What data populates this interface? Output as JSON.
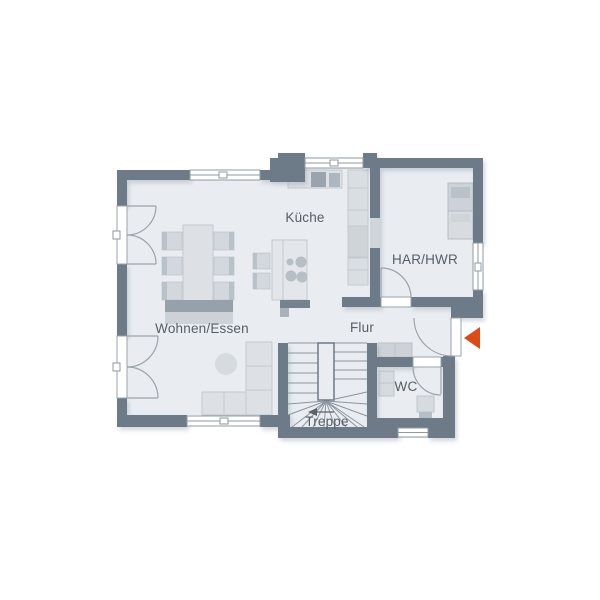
{
  "rooms": {
    "wohnen_essen": {
      "label": "Wohnen/Essen"
    },
    "kueche": {
      "label": "Küche"
    },
    "har_hwr": {
      "label": "HAR/HWR"
    },
    "flur": {
      "label": "Flur"
    },
    "wc": {
      "label": "WC"
    },
    "treppe": {
      "label": "Treppe"
    }
  },
  "colors": {
    "wall": "#6d7a88",
    "floor": "#e9edf1",
    "furniture_light": "#dde1e6",
    "furniture_mid": "#ccd2d8",
    "furniture_dark": "#a9b2bb",
    "window": "#ffffff",
    "entrance_arrow": "#de4a15",
    "label_text": "#555e67",
    "background": "#ffffff"
  },
  "icons": {
    "entrance_arrow": "left-pointing-triangle",
    "stair_direction_arrow": "left-arrow"
  },
  "symbols": {
    "furniture": [
      "dining-table",
      "dining-chairs-x6",
      "dining-sideboard",
      "bar-chairs-x2",
      "kitchen-island-with-cooktop",
      "kitchen-counter-with-sink",
      "kitchen-tall-units",
      "fridge",
      "washer",
      "dryer",
      "corner-sofa",
      "coffee-table",
      "hall-sideboard",
      "wc-sink",
      "toilet",
      "winder-staircase"
    ],
    "openings": {
      "windows": 5,
      "french_doors": 2,
      "entrance_door": 1,
      "interior_doors": 2
    }
  }
}
